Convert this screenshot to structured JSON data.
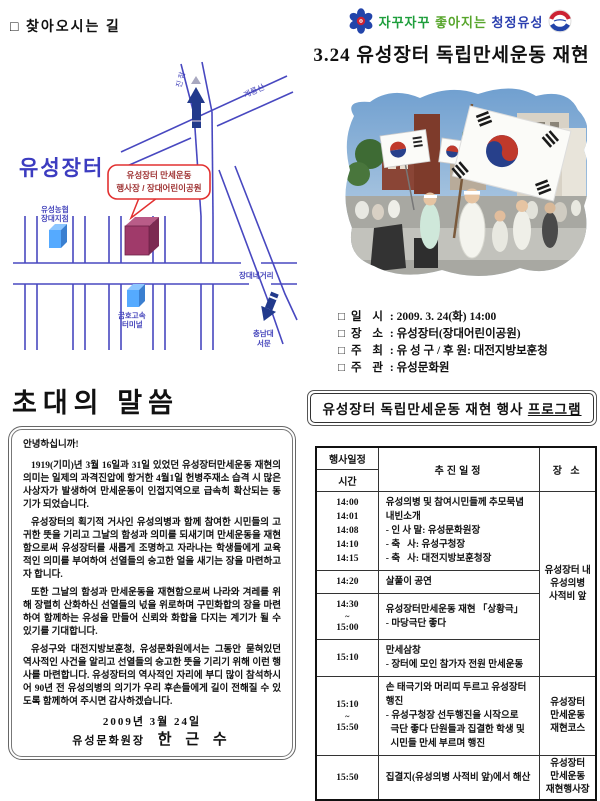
{
  "header": {
    "slogan_1": "자꾸자꾸",
    "slogan_2": "좋아지는",
    "slogan_3": "청정유성",
    "title": "3.24 유성장터 독립만세운동 재현"
  },
  "directions": {
    "title": "□ 찾아오시는 길",
    "map": {
      "area_label": "유성장터",
      "callout_line1": "유성장터 만세운동",
      "callout_line2": "행사장 / 장대어린이공원",
      "road_jinjam": "진 잠",
      "road_gyeryongsan": "계룡산",
      "nonghyup_line1": "유성농협",
      "nonghyup_line2": "장대지점",
      "kumho_line1": "금호고속",
      "kumho_line2": "터미널",
      "jangdae_crossing": "장대네거리",
      "chungnam_line1": "충남대",
      "chungnam_line2": "서문"
    }
  },
  "event_info": {
    "bullet": "□",
    "items": [
      {
        "label": "일 시",
        "sep": " : ",
        "value": "2009. 3. 24(화) 14:00"
      },
      {
        "label": "장 소",
        "sep": " : ",
        "value": "유성장터(장대어린이공원)"
      },
      {
        "label": "주 최",
        "sep": " : ",
        "value": "유 성 구 / 후 원: 대전지방보훈청"
      },
      {
        "label": "주 관",
        "sep": " : ",
        "value": "유성문화원"
      }
    ]
  },
  "invitation": {
    "title": "초대의 말씀",
    "greeting": "안녕하십니까!",
    "paragraphs": [
      "1919(기미)년 3월 16일과 31일 있었던 유성장터만세운동 재현의 의미는 일제의 과격진압에 항거한 4월1일 헌병주재소 습격 시 많은 사상자가 발생하여 만세운동이 인접지역으로 급속히 확산되는 동기가 되었습니다.",
      "유성장터의 획기적 거사인 유성의병과 함께 참여한 시민들의 고귀한 뜻을 기리고 그날의 함성과 의미를 되새기며 만세운동을 재현함으로써 유성장터를 새롭게 조명하고 자라나는 학생들에게 교육적인 의미를 부여하여 선열들의 숭고한 얼을 새기는 장을 마련하고자 합니다.",
      "또한 그날의 함성과 만세운동을 재현함으로써 나라와 겨레를 위해 장렬히 산화하신 선열들의 넋을 위로하며 구민화합의 장을 마련하여 함께하는 유성을 만들어 신뢰와 화합을 다지는 계기가 될 수 있기를 기대합니다.",
      "유성구와 대전지방보훈청, 유성문화원에서는 그동안 묻혀있던 역사적인 사건을 알리고 선열들의 숭고한 뜻을 기리기 위해 이런 행사를 마련합니다. 유성장터의 역사적인 자리에 부디 많이 참석하시어 90년 전 유성의병의 의기가 우리 후손들에게 길이 전해질 수 있도록 함께하여 주시면 감사하겠습니다."
    ],
    "date": "2009년 3월 24일",
    "signer_title": "유성문화원장",
    "signer_name": "한 근 수"
  },
  "program": {
    "title_main": "유성장터 독립만세운동 재현 행사 ",
    "title_underlined": "프로그램",
    "table": {
      "header": {
        "col1_top": "행사일정",
        "col1_bottom": "시간",
        "col2": "추진일정",
        "col3": "장 소"
      },
      "rows": [
        {
          "times": [
            "14:00",
            "14:01",
            "14:08",
            "14:10",
            "14:15"
          ],
          "lines": [
            "유성의병 및 참여시민들께 추모묵념",
            "내빈소개",
            "- 인 사 말: 유성문화원장",
            "- 축   사: 유성구청장",
            "- 축   사: 대전지방보훈청장"
          ],
          "place": {
            "text": "유성장터 내\n유성의병\n사적비 앞",
            "rowspan": 4
          }
        },
        {
          "times": [
            "14:20"
          ],
          "lines": [
            "살풀이 공연"
          ]
        },
        {
          "times": [
            "14:30",
            "~",
            "15:00"
          ],
          "lines": [
            "유성장터만세운동 재현 「상황극」",
            "- 마당극단 좋다"
          ]
        },
        {
          "times": [
            "15:10"
          ],
          "lines": [
            "만세삼창",
            "- 장터에 모인 참가자 전원 만세운동"
          ]
        },
        {
          "times": [
            "15:10",
            "~",
            "15:50"
          ],
          "lines": [
            "손 태극기와 머리띠 두르고 유성장터 행진",
            "- 유성구청장 선두행진을 시작으로",
            "  극단 좋다 단원들과 집결한 학생 및",
            "  시민들 만세 부르며 행진"
          ],
          "place": {
            "text": "유성장터\n만세운동\n재현코스",
            "rowspan": 1
          }
        },
        {
          "times": [
            "15:50"
          ],
          "lines": [
            "집결지(유성의병 사적비 앞)에서 해산"
          ],
          "place": {
            "text": "유성장터\n만세운동\n재현행사장",
            "rowspan": 1
          }
        }
      ]
    }
  },
  "colors": {
    "map_road_blue": "#4848c0",
    "map_label_blue": "#4444bb",
    "area_label_blue": "#3c3cc0",
    "callout_red": "#e23030",
    "venue_purple": "#a03a6a",
    "landmark_blue": "#55aaff",
    "slogan_green": "#1e9e3c",
    "slogan_green2": "#57a52b",
    "slogan_blue": "#2b3faf"
  }
}
